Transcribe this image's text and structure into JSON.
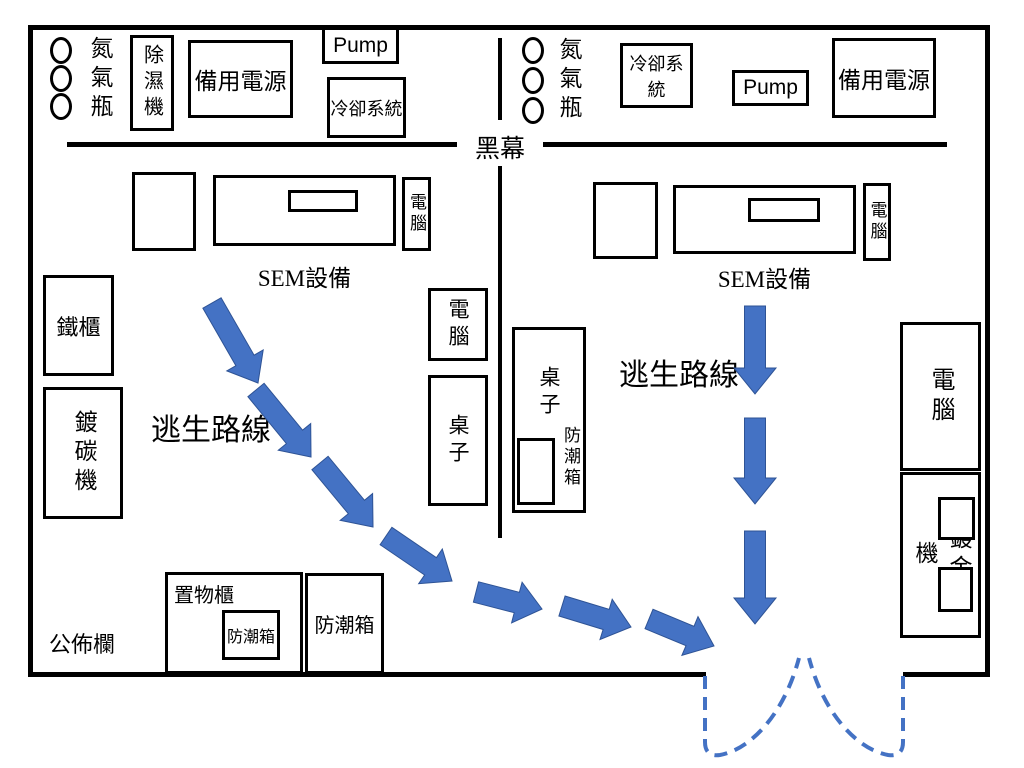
{
  "colors": {
    "accent_blue": "#4472C4",
    "wall_black": "#000000"
  },
  "labels": {
    "curtain": "黑幕",
    "bulletin_board": "公佈欄",
    "sem_left": "SEM設備",
    "sem_right": "SEM設備",
    "escape_route_left": "逃生路線",
    "escape_route_right": "逃生路線"
  },
  "equipment": {
    "gas_bottles_left": "氮氣瓶",
    "gas_bottles_right": "氮氣瓶",
    "dehumidifier": "除濕機",
    "backup_power_left": "備用電源",
    "pump_left": "Pump",
    "cooling_left": "冷卻系統",
    "cooling_right": "冷卻系統",
    "pump_right": "Pump",
    "backup_power_right": "備用電源",
    "computer_sem_left": "電腦",
    "computer_sem_right": "電腦",
    "iron_cabinet": "鐵櫃",
    "carbon_coater": "鍍碳機",
    "computer_mid": "電腦",
    "table_mid": "桌子",
    "table_right": "桌子",
    "drybox_table": "防潮箱",
    "computer_right": "電腦",
    "gold_coater": "鍍金機",
    "storage_cabinet": "置物櫃",
    "drybox_storage": "防潮箱",
    "drybox_bottom": "防潮箱"
  },
  "escape_route": {
    "arrow_color": "#4472C4",
    "arrow_edge_color": "#2E5395",
    "arrows": [
      {
        "x1": 212,
        "y1": 303,
        "x2": 258,
        "y2": 383
      },
      {
        "x1": 256,
        "y1": 390,
        "x2": 311,
        "y2": 457
      },
      {
        "x1": 320,
        "y1": 463,
        "x2": 373,
        "y2": 527
      },
      {
        "x1": 386,
        "y1": 536,
        "x2": 452,
        "y2": 581
      },
      {
        "x1": 476,
        "y1": 592,
        "x2": 542,
        "y2": 609
      },
      {
        "x1": 562,
        "y1": 606,
        "x2": 631,
        "y2": 627
      },
      {
        "x1": 649,
        "y1": 619,
        "x2": 714,
        "y2": 646
      },
      {
        "x1": 755,
        "y1": 306,
        "x2": 755,
        "y2": 394
      },
      {
        "x1": 755,
        "y1": 418,
        "x2": 755,
        "y2": 504
      },
      {
        "x1": 755,
        "y1": 531,
        "x2": 755,
        "y2": 624
      }
    ],
    "door_swing_paths": [
      "M 705 676 L 705 742 Q 705 757 720 755 C 748 750 783 718 799 658",
      "M 903 676 L 903 742 Q 903 757 888 755 C 860 750 825 718 809 658"
    ]
  }
}
